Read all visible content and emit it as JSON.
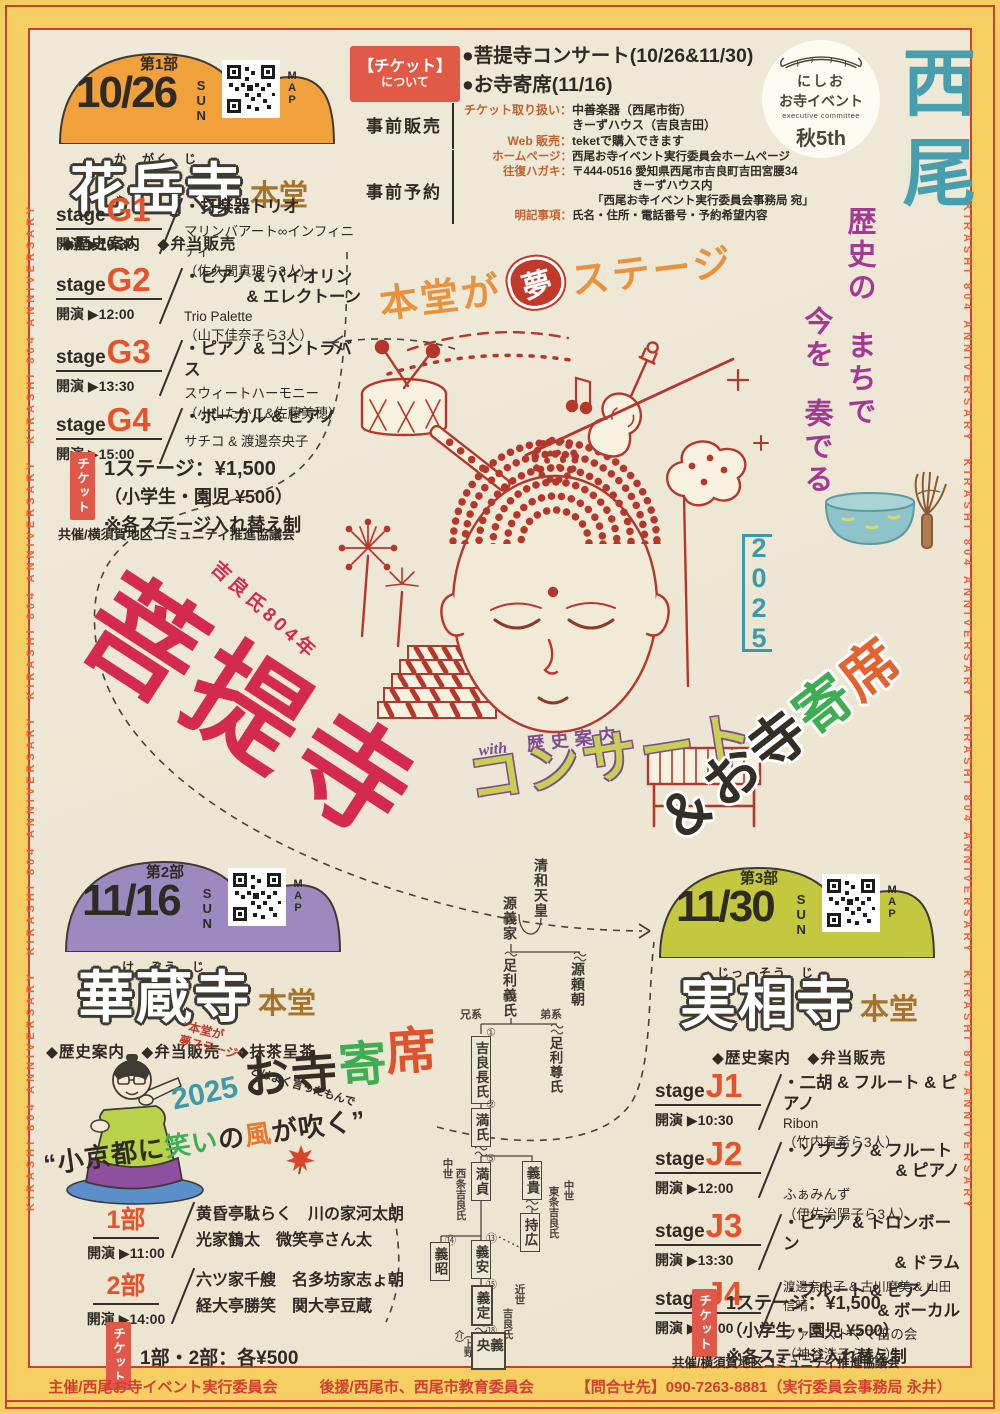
{
  "edge_text": "KIRASHI 804 ANNIVERSARY　KIRASHI 804 ANNIVERSARY　KIRASHI 804 ANNIVERSARY　KIRASHI 804 ANNIVERSARY",
  "labels": {
    "stage_word": "stage",
    "ticket_tag": "チケット"
  },
  "ticket_info": {
    "box_line1": "【チケット】",
    "box_line2": "について",
    "bullet1": "●菩提寺コンサート(10/26&11/30)",
    "bullet2": "●お寺寄席(11/16)",
    "presale_label": "事前販売",
    "presale_rows": [
      {
        "label": "チケット取り扱い：",
        "text": "中善楽器（西尾市街）"
      },
      {
        "label": "",
        "text": "きーずハウス（吉良吉田）"
      },
      {
        "label": "Web 販売：",
        "text": "teketで購入できます"
      }
    ],
    "reserve_label": "事前予約",
    "reserve_rows": [
      {
        "label": "ホームページ：",
        "text": "西尾お寺イベント実行委員会ホームページ"
      },
      {
        "label": "往復ハガキ：",
        "text": "〒444-0516 愛知県西尾市吉良町吉田宮腰34"
      },
      {
        "label": "",
        "text": "きーずハウス内"
      },
      {
        "label": "",
        "text": "「西尾お寺イベント実行委員会事務局 宛」"
      },
      {
        "label": "明記事項：",
        "text": "氏名・住所・電話番号・予約希望内容"
      }
    ]
  },
  "logo": {
    "line1": "にしお",
    "line2": "お寺イベント",
    "line3": "executive committee",
    "line4": "秋5th"
  },
  "brand": "西尾",
  "slogan": {
    "col1a": "歴史の",
    "col1b": "まちで",
    "col2a": "今を",
    "col2b": "奏でる"
  },
  "catch": {
    "pre": "本堂が",
    "dream": "夢",
    "post": "ステージ"
  },
  "title": {
    "anniversary": "吉良氏804年",
    "main": "菩提寺",
    "with_word": "with",
    "with_note": "歴史案内",
    "concert": "コンサート",
    "amp": "＆お寺",
    "yose1": "寄",
    "yose2": "席",
    "year": "2025"
  },
  "part1": {
    "part_label": "第1部",
    "date": "10/26",
    "day": "SUN",
    "map": "MAP",
    "furigana": "か　がく　じ",
    "temple": "花岳寺",
    "hall": "本堂",
    "features": "◆歴史案内　◆弁当販売",
    "stages": [
      {
        "id": "G1",
        "time": "開演 ▶10:30",
        "title": "・打楽器トリオ",
        "performer": "マリンバアート∞インフィニティ",
        "note": "（佐久間真理ら3人）"
      },
      {
        "id": "G2",
        "time": "開演 ▶12:00",
        "title": "・ピアノ & バイオリン",
        "title2": "& エレクトーン",
        "performer": "Trio Palette",
        "note": "（山下佳奈子ら3人）"
      },
      {
        "id": "G3",
        "time": "開演 ▶13:30",
        "title": "・ピアノ & コントラバス",
        "performer": "スウィートハーモニー",
        "note": "（小山たかこ&佐藤美穂）"
      },
      {
        "id": "G4",
        "time": "開演 ▶15:00",
        "title": "・ボーカル & ピアノ",
        "performer": "サチコ & 渡邊奈央子"
      }
    ],
    "ticket_line1": "1ステージ：¥1,500",
    "ticket_line2": "（小学生・園児 ¥500）",
    "ticket_line3": "※各ステージ入れ替え制",
    "cohost": "共催/横須賀地区コミュニティ推進協議会"
  },
  "part2": {
    "part_label": "第2部",
    "date": "11/16",
    "day": "SUN",
    "map": "MAP",
    "furigana": "け　ぞう　じ",
    "temple": "華蔵寺",
    "hall": "本堂",
    "features": "◆歴史案内　◆弁当販売　◆抹茶呈茶",
    "note_red1": "“本堂が",
    "note_red2": "夢ステージ”",
    "note_small": "とはよく言ったもんで",
    "yose_year": "2025",
    "yose_otera": "お寺",
    "yose_yo": "寄",
    "yose_seki": "席",
    "phrase_a": "“小京都に",
    "phrase_b": "笑い",
    "phrase_c": "の",
    "phrase_d": "風",
    "phrase_e": "が吹く”",
    "parts": [
      {
        "id": "1部",
        "time": "開演 ▶11:00",
        "line1": "黄昏亭駄らく　川の家河太朗",
        "line2": "光家鶴太　微笑亭さん太"
      },
      {
        "id": "2部",
        "time": "開演 ▶14:00",
        "line1": "六ツ家千艘　名多坊家志ょ朝",
        "line2": "経大亭勝笑　関大亭豆蔵"
      }
    ],
    "ticket": "1部・2部：各¥500"
  },
  "part3": {
    "part_label": "第3部",
    "date": "11/30",
    "day": "SUN",
    "map": "MAP",
    "furigana": "じっ　そう　じ",
    "temple": "実相寺",
    "hall": "本堂",
    "features": "◆歴史案内　◆弁当販売",
    "stages": [
      {
        "id": "J1",
        "time": "開演 ▶10:30",
        "title": "・二胡 & フルート & ピアノ",
        "performer": "Ribon",
        "note": "（竹内有希ら3人）"
      },
      {
        "id": "J2",
        "time": "開演 ▶12:00",
        "title": "・ソプラノ & フルート",
        "title2": "& ピアノ",
        "performer": "ふぁみんず",
        "note": "（伊佐治陽子ら3人）"
      },
      {
        "id": "J3",
        "time": "開演 ▶13:30",
        "title": "・ピアノ & トロンボーン",
        "title2": "& ドラム",
        "performer": "渡邊奈央子 & 古川磨美 & 山田信晴"
      },
      {
        "id": "J4",
        "time": "開演 ▶15:00",
        "title": "・フルート & ピアノ",
        "title2": "& ボーカル",
        "performer": "ファーストママ笛の会",
        "note": "（神谷浩子ら4人）"
      }
    ],
    "ticket_line1": "1ステージ：¥1,500",
    "ticket_line2": "（小学生・園児 ¥500）",
    "ticket_line3": "※各ステージ入れ替え制",
    "cohost": "共催/横須賀地区コミュニティ推進協議会"
  },
  "tree": {
    "seiwa": "清和天皇",
    "yoshiie": "源義家",
    "yoritomo": "源頼朝",
    "yoshiuji": "足利義氏",
    "elder": "兄系",
    "younger": "弟系",
    "takauji": "足利尊氏",
    "n1": "①",
    "osauji": "吉良長氏",
    "n2": "②",
    "mitsuuji": "満氏",
    "n5": "⑤",
    "mitsusada": "満貞",
    "yoshitaka": "義貴",
    "mochihiro": "持広",
    "n14": "⑭",
    "yoshiaki": "義昭",
    "n13": "⑬",
    "yoshiyasu": "義安",
    "n15": "⑮",
    "yoshisada": "義定",
    "n18": "⑱",
    "yoshihisa": "義央",
    "kira_note": "（上野介）",
    "west_era": "中世",
    "west_name": "西条吉良氏",
    "east_era": "中世",
    "east_name": "東条吉良氏",
    "kinsei_era": "近世",
    "kinsei_name": "吉良氏"
  },
  "footer": {
    "host": "主催/西尾お寺イベント実行委員会",
    "support": "後援/西尾市、西尾市教育委員会",
    "contact": "【問合せ先】090-7263-8881（実行委員会事務局 永井）"
  },
  "colors": {
    "accent_red": "#d42a4d",
    "cloud_orange": "#f0a13c",
    "cloud_purple": "#9b8ac0",
    "cloud_green": "#c3c83e",
    "teal": "#3e9aa9",
    "frame_yellow": "#f6cf62"
  }
}
